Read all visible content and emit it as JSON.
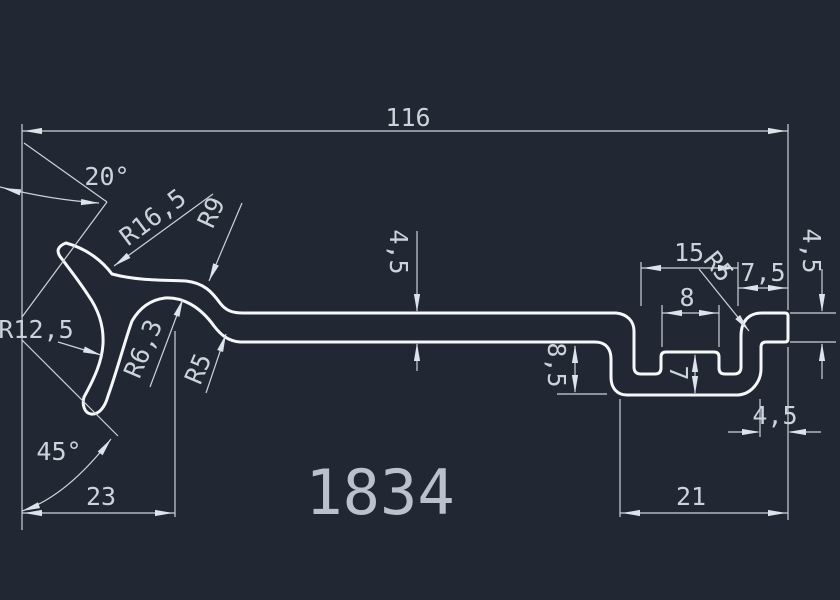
{
  "canvas": {
    "background": "#212833",
    "profile_line_color": "#f5f7f9",
    "dimension_color": "#ccd3db"
  },
  "title": {
    "text": "1834"
  },
  "dims": {
    "overall_width": "116",
    "top_angle": "20°",
    "bottom_angle": "45°",
    "left_foot_width": "23",
    "plate_thickness": "4,5",
    "groove_width": "15",
    "tongue_width": "8",
    "lip_width": "7,5",
    "right_edge_thickness": "4,5",
    "step_depth": "8,5",
    "tongue_height": "7",
    "lip_offset": "4,5",
    "channel_width": "21"
  },
  "radii": {
    "claw_outer": "R16,5",
    "claw_mouth": "R12,5",
    "neck_outer": "R9",
    "hump_inner": "R6,3",
    "neck_fillet": "R5",
    "corner_right": "R5"
  }
}
